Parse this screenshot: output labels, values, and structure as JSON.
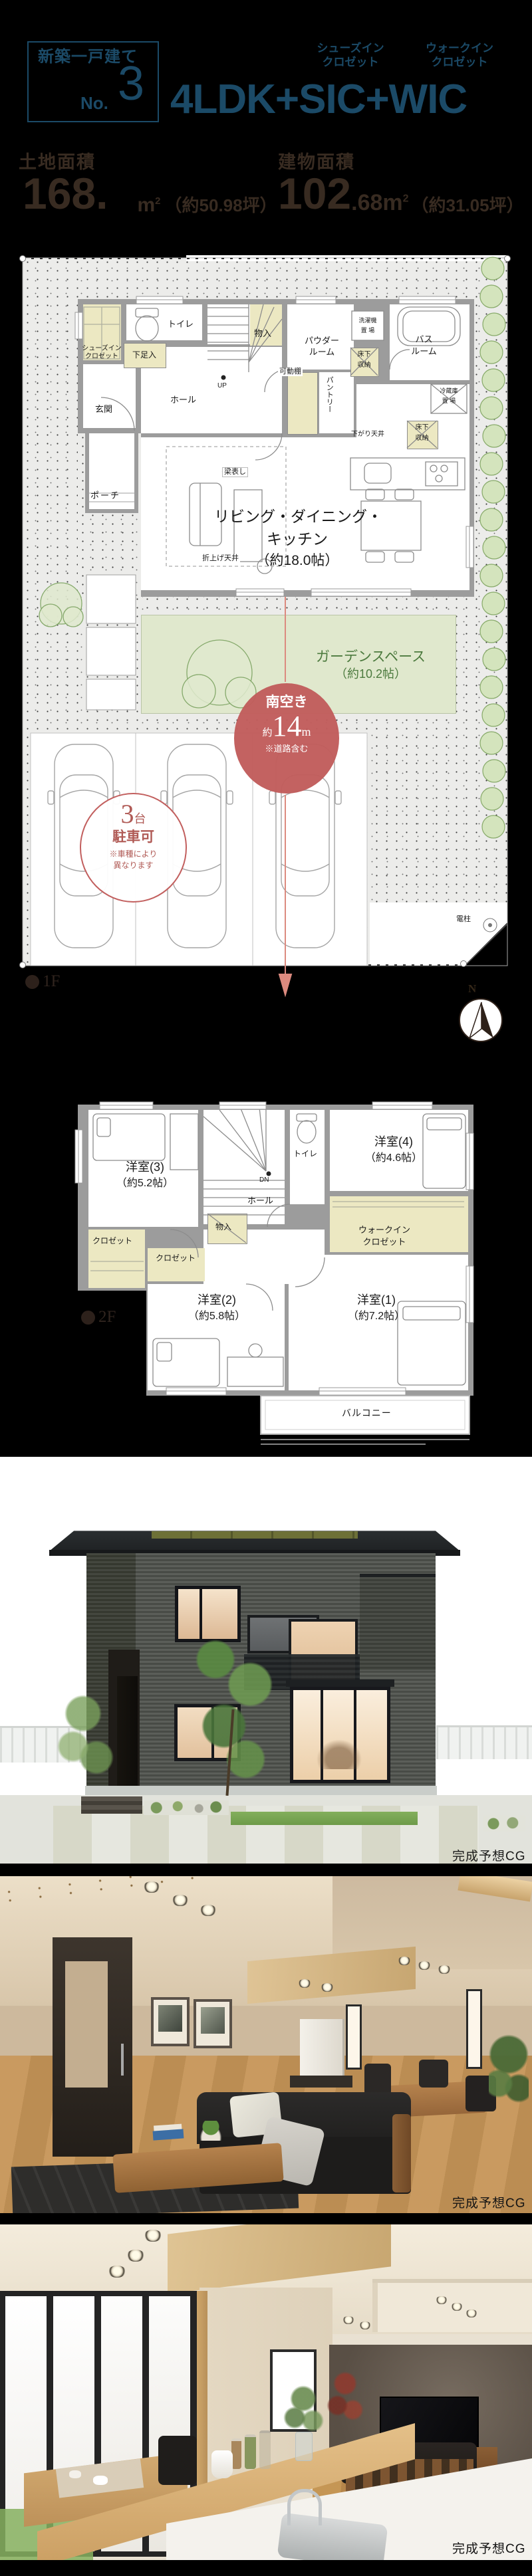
{
  "colors": {
    "accent_blue": "#1b4a67",
    "accent_red": "#c25f5e",
    "plan_beige": "#ece8c2",
    "garden_green": "#e0e8cd",
    "text_dark_brown": "#382b21"
  },
  "header": {
    "badge_label": "新築一戸建て",
    "badge_no_prefix": "No.",
    "badge_no": "3",
    "plan_title": "4LDK+SIC+WIC",
    "sic_note_1": "シューズイン",
    "sic_note_2": "クロゼット",
    "wic_note_1": "ウォークイン",
    "wic_note_2": "クロゼット",
    "land_label": "土地面積",
    "land_value": "168.",
    "land_unit": "m",
    "land_sup": "2",
    "land_tsubo": "（約50.98坪）",
    "bldg_label": "建物面積",
    "bldg_value_int": "102",
    "bldg_value_frac": ".68",
    "bldg_unit": "m",
    "bldg_sup": "2",
    "bldg_tsubo": "（約31.05坪）"
  },
  "f1": {
    "marker": "1F",
    "compass_n": "N",
    "sic_1": "シューズイン",
    "sic_2": "クロゼット",
    "shoe": "下足入",
    "toilet": "トイレ",
    "mono": "物入",
    "powder_1": "パウダー",
    "powder_2": "ルーム",
    "wash_1": "洗濯機",
    "wash_2": "置 場",
    "floor_st_1": "床下",
    "floor_st_2": "収納",
    "bath_1": "バス",
    "bath_2": "ルーム",
    "shelf": "可動棚",
    "pantry": "パントリー",
    "fridge_1": "冷蔵庫",
    "fridge_2": "置 場",
    "down_ceil": "下がり天井",
    "beam": "梁表し",
    "up": "UP",
    "hall": "ホール",
    "genkan": "玄関",
    "porch": "ポーチ",
    "ldk_1": "リビング・ダイニング・",
    "ldk_2": "キッチン",
    "ldk_3": "（約18.0帖）",
    "ori_ceil": "折上げ天井",
    "garden_1": "ガーデンスペース",
    "garden_2": "（約10.2帖）",
    "south_1": "南空き",
    "south_2a": "約",
    "south_2b": "14",
    "south_2c": "m",
    "south_3": "※道路含む",
    "park_1a": "3",
    "park_1b": "台",
    "park_2": "駐車可",
    "park_3": "※車種により",
    "park_4": "異なります",
    "pole": "電柱"
  },
  "f2": {
    "marker": "2F",
    "r3": "洋室(3)",
    "r3s": "（約5.2帖）",
    "r4": "洋室(4)",
    "r4s": "（約4.6帖）",
    "toilet": "トイレ",
    "dn": "DN",
    "hall": "ホール",
    "mono": "物入",
    "closet_a": "クロゼット",
    "closet_b": "クロゼット",
    "wic_1": "ウォークイン",
    "wic_2": "クロゼット",
    "r2": "洋室(2)",
    "r2s": "（約5.8帖）",
    "r1": "洋室(1)",
    "r1s": "（約7.2帖）",
    "balcony": "バルコニー"
  },
  "captions": {
    "exterior": "完成予想CG",
    "interior1": "完成予想CG",
    "interior2": "完成予想CG"
  }
}
